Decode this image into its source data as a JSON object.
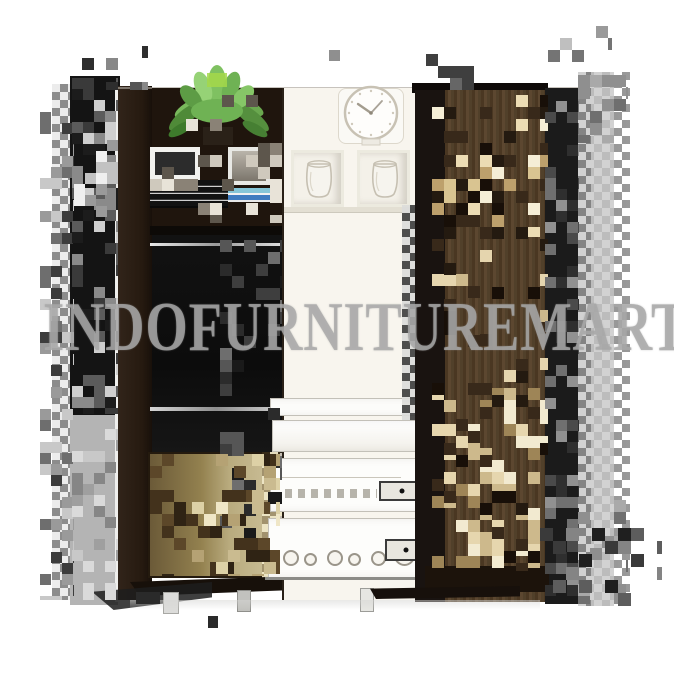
{
  "watermark": {
    "text": "INDOFURNITUREMART"
  },
  "clock": {
    "time": "10:10"
  },
  "colors": {
    "background": "#ffffff",
    "watermark_gray": "#a8a8a8",
    "cabinet_black": "#141414",
    "wenge_brown": "#2b1d12",
    "wood_brown": "#54402a",
    "beige_block": "#e8d8b2",
    "khaki_wood": "#b0a274",
    "cream_panel": "#f8f5ee",
    "checker_gray": "#c6c6c6",
    "plant_green": "#6fb254"
  }
}
